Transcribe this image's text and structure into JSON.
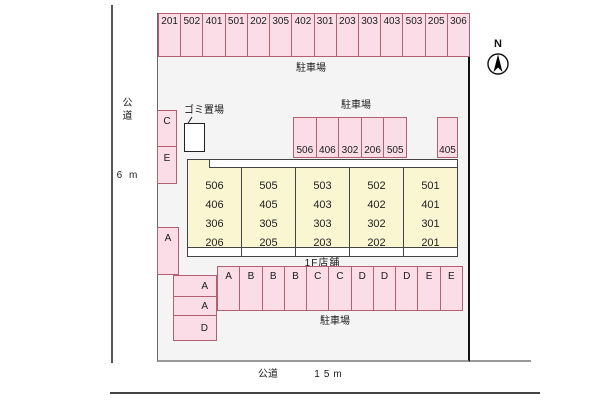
{
  "compass": {
    "label": "N"
  },
  "roads": {
    "left_label": "公道",
    "left_width": "6 m",
    "bottom_label": "公道",
    "bottom_width": "15m"
  },
  "garbage_area": {
    "label": "ゴミ置場"
  },
  "parking_top": {
    "label": "駐車場",
    "spaces": [
      "201",
      "502",
      "401",
      "501",
      "202",
      "305",
      "402",
      "301",
      "203",
      "303",
      "403",
      "503",
      "205",
      "306"
    ]
  },
  "parking_mid": {
    "label": "駐車場",
    "spaces": [
      "506",
      "406",
      "302",
      "206",
      "505"
    ],
    "detached_space": "405"
  },
  "parking_bottom": {
    "label": "駐車場",
    "spaces": [
      "A",
      "B",
      "B",
      "B",
      "C",
      "C",
      "D",
      "D",
      "D",
      "E",
      "E"
    ]
  },
  "side_spaces": {
    "upper": [
      "C",
      "E"
    ],
    "middle": [
      "A"
    ],
    "lower": [
      "A",
      "A",
      "D"
    ]
  },
  "building": {
    "label": "1F店舗",
    "columns": [
      [
        "506",
        "406",
        "306",
        "206"
      ],
      [
        "505",
        "405",
        "305",
        "205"
      ],
      [
        "503",
        "403",
        "303",
        "203"
      ],
      [
        "502",
        "402",
        "302",
        "202"
      ],
      [
        "501",
        "401",
        "301",
        "201"
      ]
    ]
  },
  "colors": {
    "space_fill": "#fbdde8",
    "space_border": "#b06070",
    "building_fill": "#fbf6d2",
    "building_border": "#444444",
    "site_fill": "#f4f4f4"
  }
}
